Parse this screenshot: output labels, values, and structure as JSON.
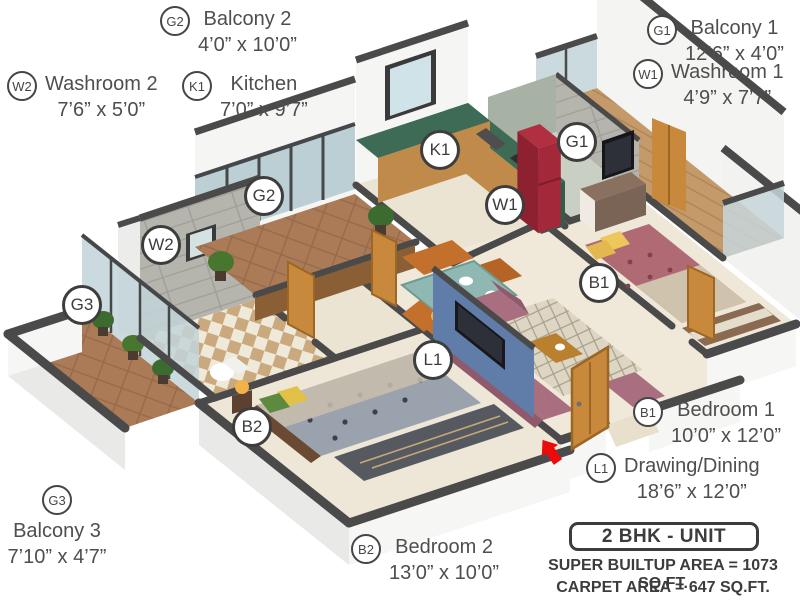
{
  "plan": {
    "unit_label": "2 BHK - UNIT",
    "summary": {
      "super_builtup": "SUPER BUILTUP AREA = 1073 SQ.FT.",
      "carpet": "CARPET AREA = 647 SQ.FT."
    }
  },
  "rooms": [
    {
      "code": "G2",
      "name": "Balcony 2",
      "size": "4’0” x 10’0”"
    },
    {
      "code": "K1",
      "name": "Kitchen",
      "size": "7’0” x 9’7”"
    },
    {
      "code": "W2",
      "name": "Washroom 2",
      "size": "7’6” x 5’0”"
    },
    {
      "code": "G1",
      "name": "Balcony 1",
      "size": "12’6” x 4’0”"
    },
    {
      "code": "W1",
      "name": "Washroom 1",
      "size": "4’9” x 7’7”"
    },
    {
      "code": "B1",
      "name": "Bedroom 1",
      "size": "10’0” x 12’0”"
    },
    {
      "code": "L1",
      "name": "Drawing/Dining",
      "size": "18’6” x 12’0”"
    },
    {
      "code": "B2",
      "name": "Bedroom 2",
      "size": "13’0” x 10’0”"
    },
    {
      "code": "G3",
      "name": "Balcony 3",
      "size": "7’10” x 4’7”"
    }
  ],
  "colors": {
    "wall_top": "#4a4a4a",
    "wall_face": "#f4f4f2",
    "floor_cream": "#eee6d5",
    "balcony_wood": "#c59a6a",
    "balcony_tile": "#9b6f4e",
    "terracotta": "#ab7a57",
    "kitchen_marble": "#3e6b55",
    "cabinet_wood": "#c08b4a",
    "fridge_red": "#a3283a",
    "sofa_mauve": "#a96e80",
    "bed1_rose": "#b06a74",
    "bed2_grey": "#9aa2ae",
    "accent_blue_wall": "#5f7da8",
    "door_wood": "#c8893c",
    "entry_arrow_red": "#ec0b0b",
    "label_text": "#4e4e4e"
  }
}
